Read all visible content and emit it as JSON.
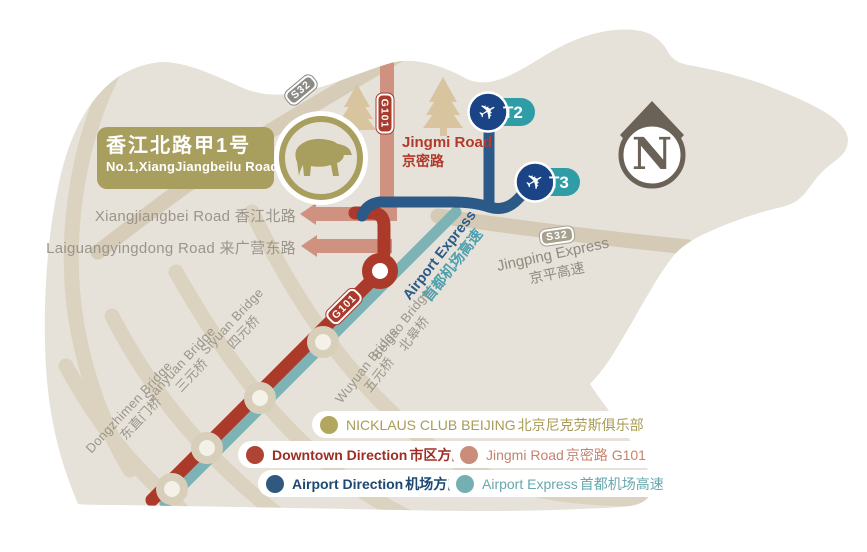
{
  "palette": {
    "bear_fill": "#e6e2d9",
    "tan_road": "#dbd2bf",
    "jingping_band": "#d4cab5",
    "olive": "#a89e5e",
    "downtown_red": "#ac3a2b",
    "jingmi_salmon": "#cf9180",
    "airport_navy": "#2b5a89",
    "terminal_blue": "#1a4485",
    "terminal_pill_teal": "#2f9da6",
    "express_teal": "#7db3b5",
    "compass_dark": "#6b6257"
  },
  "compass": {
    "letter": "N"
  },
  "destination_box": {
    "line1_zh": "香江北路甲1号",
    "line2_en": "No.1,XiangJiangbeilu Road"
  },
  "badges": {
    "s32_a": "S32",
    "g101_a": "G101",
    "g101_b": "G101",
    "s32_b": "S32"
  },
  "terminals": {
    "t2": "T2",
    "t3": "T3",
    "plane_icon": "✈"
  },
  "roads": {
    "jingmi": {
      "en": "Jingmi Road",
      "zh": "京密路"
    },
    "xiangjiangbei": {
      "label": "Xiangjiangbei Road 香江北路"
    },
    "laiguangyingdong": {
      "label": "Laiguangyingdong Road 来广营东路"
    },
    "airport_express": {
      "en": "Airport Express",
      "zh": "首都机场高速"
    },
    "jingping": {
      "en": "Jingping Express",
      "zh": "京平高速"
    }
  },
  "bridges": [
    {
      "en": "Siyuan Bridge",
      "zh": "四元桥"
    },
    {
      "en": "Sanyuan Bridge",
      "zh": "三元桥"
    },
    {
      "en": "Dongzhimen Bridge",
      "zh": "东直门桥"
    },
    {
      "en": "Beigao Bridge",
      "zh": "北皋桥"
    },
    {
      "en": "Wuyuan Bridge",
      "zh": "五元桥"
    }
  ],
  "legend": {
    "items": [
      {
        "en": "NICKLAUS CLUB BEIJING",
        "zh": "北京尼克劳斯俱乐部",
        "dot_color": "#b3a75f",
        "text_color": "#a89c55"
      },
      {
        "en": "Downtown Direction",
        "zh": "市区方向",
        "dot_color": "#b04434",
        "text_color": "#9e2d23"
      },
      {
        "en": "Jingmi Road",
        "zh": "京密路 G101",
        "dot_color": "#c98d79",
        "text_color": "#c5836f"
      },
      {
        "en": "Airport Direction",
        "zh": "机场方向",
        "dot_color": "#31597f",
        "text_color": "#1c4871"
      },
      {
        "en": "Airport Express",
        "zh": "首都机场高速",
        "dot_color": "#74afb2",
        "text_color": "#67a8ae"
      }
    ]
  }
}
